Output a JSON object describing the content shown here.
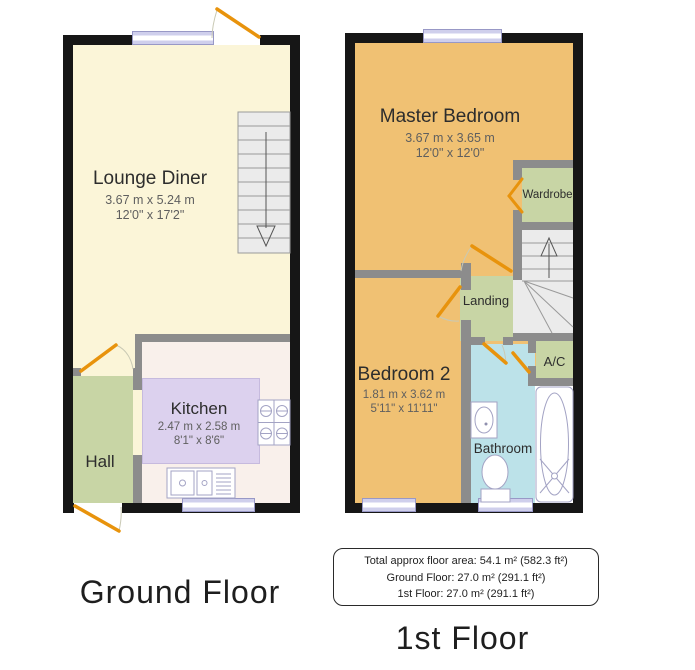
{
  "colors": {
    "wall": "#161616",
    "partition": "#8c8c8c",
    "lounge_floor": "#FBF5D8",
    "kitchen_floor": "#F9F0EB",
    "kitchen_unit": "#DCD1EE",
    "hall_green": "#C8D5A5",
    "bedroom_orange": "#F0C173",
    "bathroom_blue": "#BCE2E9",
    "door": "#E8930C",
    "window": "#DEDEF4",
    "stairs": "#EBEBEB"
  },
  "ground_floor": {
    "title": "Ground Floor",
    "lounge": {
      "name": "Lounge Diner",
      "metric": "3.67 m x 5.24 m",
      "imperial": "12'0\" x 17'2\""
    },
    "kitchen": {
      "name": "Kitchen",
      "metric": "2.47 m x 2.58 m",
      "imperial": "8'1\" x 8'6\""
    },
    "hall": {
      "name": "Hall"
    }
  },
  "first_floor": {
    "title": "1st Floor",
    "master_bedroom": {
      "name": "Master Bedroom",
      "metric": "3.67 m x 3.65 m",
      "imperial": "12'0\" x 12'0\""
    },
    "bedroom2": {
      "name": "Bedroom 2",
      "metric": "1.81 m x 3.62 m",
      "imperial": "5'11\" x 11'11\""
    },
    "landing": {
      "name": "Landing"
    },
    "wardrobe": {
      "name": "Wardrobe"
    },
    "bathroom": {
      "name": "Bathroom"
    },
    "ac": {
      "name": "A/C"
    }
  },
  "summary": {
    "total": "Total approx floor area: 54.1 m² (582.3 ft²)",
    "ground": "Ground Floor: 27.0 m² (291.1 ft²)",
    "first": "1st Floor: 27.0 m² (291.1 ft²)"
  }
}
